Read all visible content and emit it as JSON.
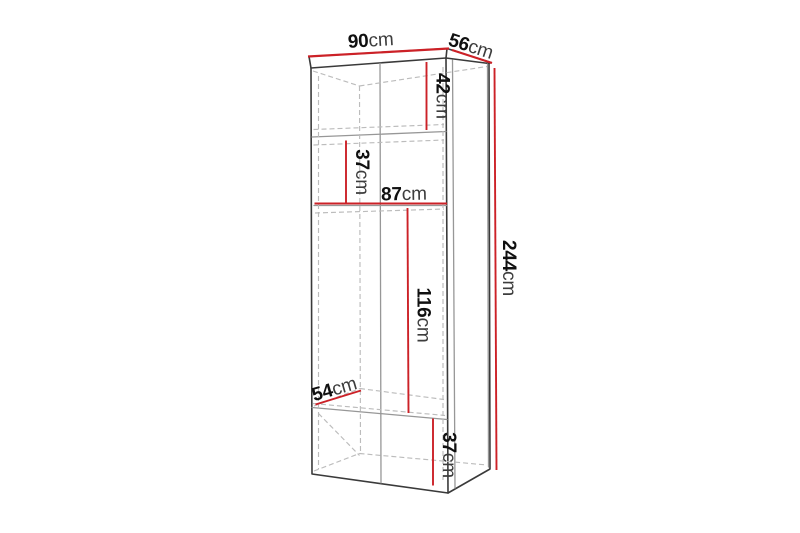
{
  "colors": {
    "background": "#ffffff",
    "dimension": "#cc2127",
    "outline": "#3a3a3a",
    "inner_edge": "#979797",
    "hidden_edge": "#bcbcbc",
    "label_value": "#101010",
    "label_unit": "#3d3d3d"
  },
  "diagram": {
    "dimensions": {
      "width": {
        "value": "90",
        "unit": "cm"
      },
      "depth": {
        "value": "56",
        "unit": "cm"
      },
      "top_section": {
        "value": "42",
        "unit": "cm"
      },
      "upper_shelf": {
        "value": "37",
        "unit": "cm"
      },
      "inner_width": {
        "value": "87",
        "unit": "cm"
      },
      "total_height": {
        "value": "244",
        "unit": "cm"
      },
      "middle_section": {
        "value": "116",
        "unit": "cm"
      },
      "inner_depth": {
        "value": "54",
        "unit": "cm"
      },
      "bottom_section": {
        "value": "37",
        "unit": "cm"
      }
    }
  }
}
